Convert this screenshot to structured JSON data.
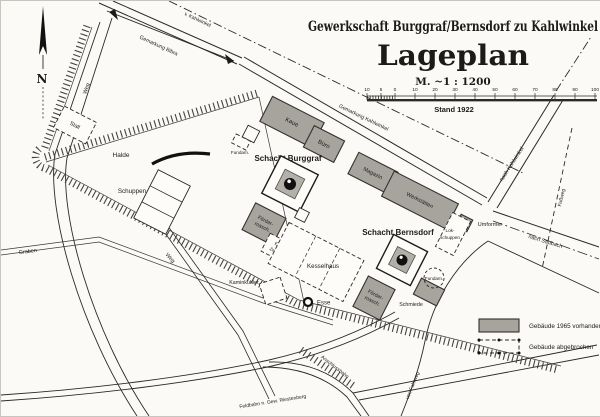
{
  "title": {
    "company": "Gewerkschaft Burggraf/Bernsdorf zu Kahlwinkel",
    "plan": "Lageplan",
    "scale": "M. ~1 : 1200",
    "stand": "Stand 1922"
  },
  "scalebar": {
    "labels": [
      "10",
      "5",
      "0",
      "10",
      "20",
      "30",
      "40",
      "50",
      "60",
      "70",
      "80",
      "90",
      "100"
    ]
  },
  "compass": {
    "north": "N"
  },
  "roads": {
    "v_kahlwinkel": "v. Kahlwinkel",
    "gemarkung_bibra": "Gemarkung Bibra",
    "gemarkung_kahlwinkel": "Gemarkung Kahlwinkel",
    "nach_kahlwinkel": "nach Kahlwinkel",
    "nach_saubach": "nach Saubach",
    "fussweg": "Fußweg",
    "weg1": "Weg",
    "weg2": "Weg",
    "graben": "Graben",
    "feldbahn": "Feldbahn n. Gew. Riestenberg",
    "anschlussbahn": "Anschlussbahn",
    "fahrweg": "von Fahrweg"
  },
  "site": {
    "halde": "Halde",
    "schuppen": "Schuppen",
    "stall": "Stall",
    "fundament_left": "Fundam.",
    "fundament_right": "Fundam.",
    "kaue": "Kaue",
    "buero": "Büro",
    "magazin": "Magazin",
    "werkstaetten": "Werkstätten",
    "schacht_burggraf": "Schacht Burggraf",
    "schacht_bernsdorf": "Schacht Bernsdorf",
    "foerder1_l1": "Förder-",
    "foerder1_l2": "masch.",
    "foerder2_l1": "Förder-",
    "foerder2_l2": "masch.",
    "elektr_l1": "Elektr.",
    "elektr_l2": "Zentrale",
    "kesselhaus": "Kesselhaus",
    "kaminkuehler": "Kaminkühler",
    "esse": "Esse",
    "schmiede": "Schmiede",
    "umformer": "Umformer",
    "lok_l1": "Lok-",
    "lok_l2": "schuppen"
  },
  "legend": {
    "existing": "Gebäude 1965 vorhanden",
    "demolished": "Gebäude abgebrochen"
  },
  "colors": {
    "paper": "#fbfaf6",
    "building": "#a7a39d",
    "ink": "#2b2a27"
  }
}
